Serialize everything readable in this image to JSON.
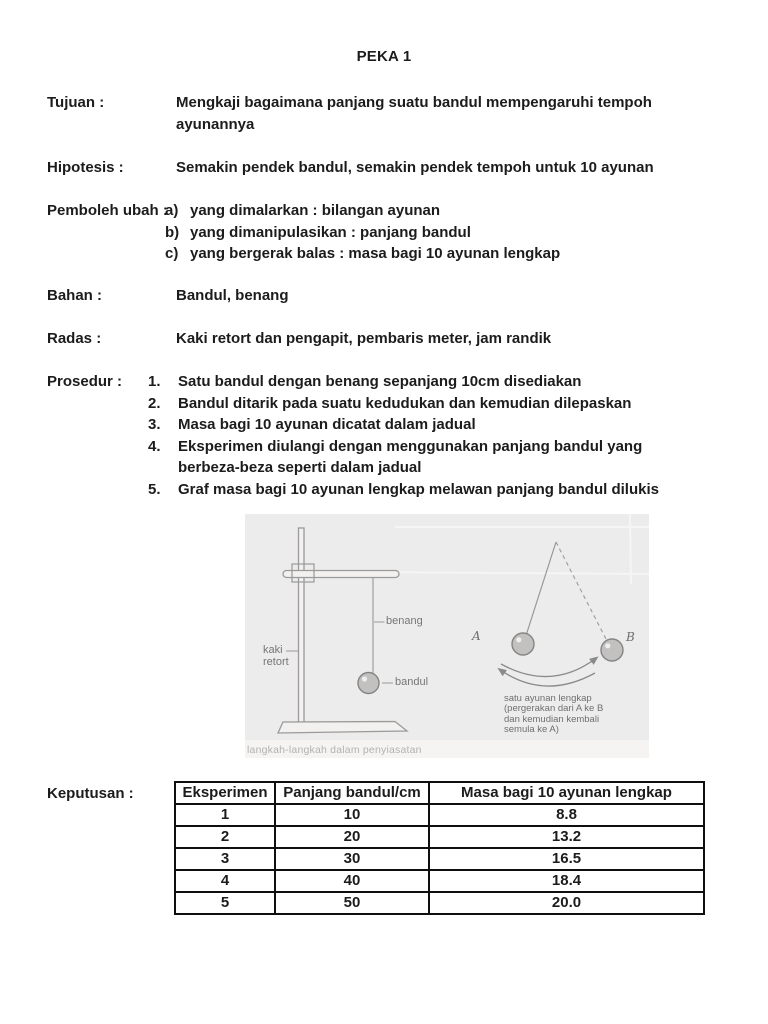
{
  "page": {
    "title": "PEKA 1",
    "background": "#ffffff"
  },
  "colors": {
    "text": "#1c1c1c",
    "table_border": "#0f0f0f",
    "figure_background": "#ececec",
    "figure_line": "#9a9a9a",
    "figure_label_text": "#767676",
    "figure_caption_text": "#b3b2b0"
  },
  "sections": {
    "tujuan": {
      "label": "Tujuan :",
      "lines": [
        "Mengkaji bagaimana panjang suatu bandul mempengaruhi tempoh",
        "ayunannya"
      ]
    },
    "hipotesis": {
      "label": "Hipotesis :",
      "text": "Semakin pendek bandul, semakin pendek tempoh untuk 10 ayunan"
    },
    "pemboleh_ubah": {
      "label": "Pemboleh ubah :",
      "items": [
        {
          "marker": "a)",
          "text": "yang dimalarkan : bilangan ayunan"
        },
        {
          "marker": "b)",
          "text": "yang dimanipulasikan : panjang bandul"
        },
        {
          "marker": "c)",
          "text": "yang bergerak balas : masa bagi 10 ayunan lengkap"
        }
      ]
    },
    "bahan": {
      "label": "Bahan :",
      "text": "Bandul, benang"
    },
    "radas": {
      "label": "Radas :",
      "text": "Kaki retort dan pengapit, pembaris meter, jam randik"
    },
    "prosedur": {
      "label": "Prosedur :",
      "items": [
        {
          "marker": "1.",
          "lines": [
            "Satu bandul dengan benang sepanjang 10cm disediakan"
          ]
        },
        {
          "marker": "2.",
          "lines": [
            "Bandul ditarik pada suatu kedudukan dan kemudian dilepaskan"
          ]
        },
        {
          "marker": "3.",
          "lines": [
            "Masa bagi 10 ayunan dicatat dalam jadual"
          ]
        },
        {
          "marker": "4.",
          "lines": [
            "Eksperimen diulangi dengan menggunakan panjang bandul yang",
            "berbeza-beza seperti dalam jadual"
          ]
        },
        {
          "marker": "5.",
          "lines": [
            "Graf masa bagi 10 ayunan lengkap melawan panjang bandul dilukis"
          ]
        }
      ]
    }
  },
  "figure": {
    "stand": {
      "label_benang": "benang",
      "label_bandul": "bandul",
      "label_kaki_line1": "kaki",
      "label_kaki_line2": "retort"
    },
    "swing": {
      "label_a": "A",
      "label_b": "B",
      "caption_line1": "satu ayunan lengkap",
      "caption_line2": "(pergerakan dari A ke B",
      "caption_line3": "dan kemudian kembali",
      "caption_line4": "semula ke A)"
    },
    "bottom_caption": "langkah-langkah dalam penyiasatan"
  },
  "results": {
    "label": "Keputusan :",
    "table": {
      "headers": [
        "Eksperimen",
        "Panjang bandul/cm",
        "Masa bagi 10 ayunan lengkap"
      ],
      "rows": [
        [
          "1",
          "10",
          "8.8"
        ],
        [
          "2",
          "20",
          "13.2"
        ],
        [
          "3",
          "30",
          "16.5"
        ],
        [
          "4",
          "40",
          "18.4"
        ],
        [
          "5",
          "50",
          "20.0"
        ]
      ]
    }
  }
}
